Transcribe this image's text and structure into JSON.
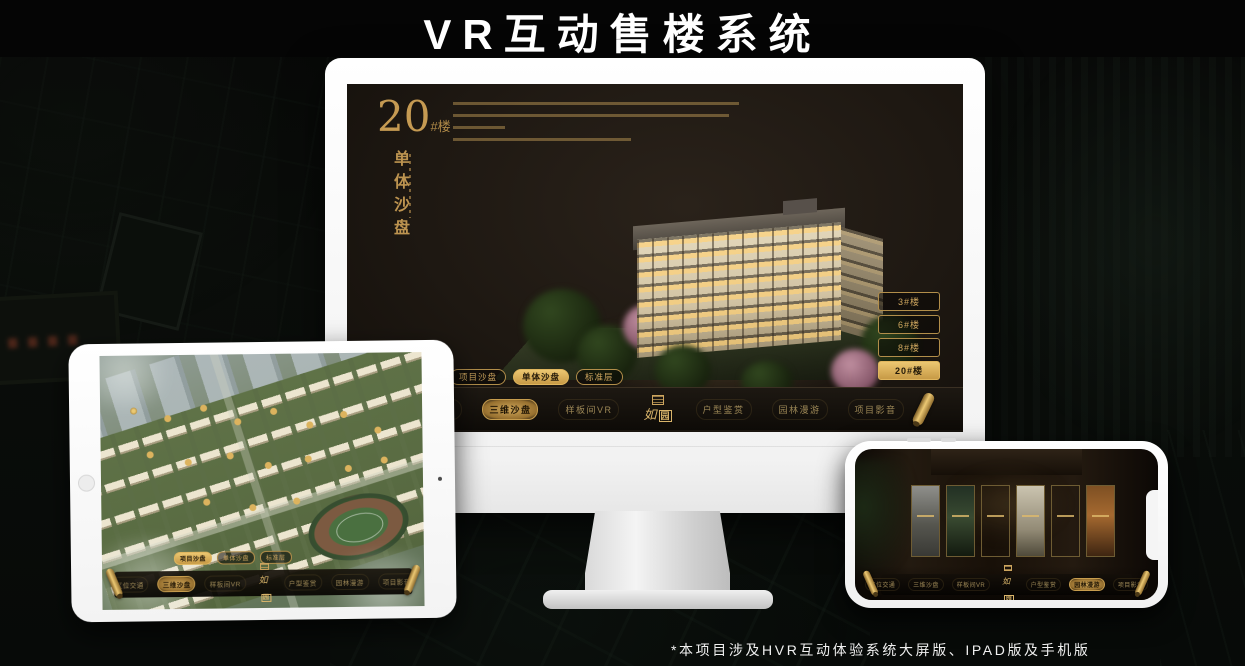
{
  "page": {
    "title": "VR互动售楼系统",
    "footnote": "*本项目涉及HVR互动体验系统大屏版、IPAD版及手机版"
  },
  "colors": {
    "gold_accent": "#cda55e",
    "gold_active": "#dcae54",
    "screen_bg": "#1e1812",
    "device_white": "#f5f5f5"
  },
  "screen": {
    "building_number": "20",
    "building_unit": "#楼",
    "subtitle": "单体沙盘",
    "floor_buttons": [
      "3#楼",
      "6#楼",
      "8#楼",
      "20#楼"
    ],
    "active_floor": "20#楼",
    "mode_tabs": [
      "项目沙盘",
      "单体沙盘",
      "标准层"
    ],
    "active_mode": "单体沙盘",
    "nav_items_left": [
      "区位交通",
      "三维沙盘",
      "样板间VR"
    ],
    "nav_items_right": [
      "户型鉴赏",
      "园林漫游",
      "项目影音"
    ],
    "active_nav": "三维沙盘",
    "logo_char1": "如",
    "logo_char2": "园"
  },
  "ipad": {
    "mode_tabs": [
      "项目沙盘",
      "单体沙盘",
      "标准层"
    ],
    "active_mode": "项目沙盘",
    "nav_items_left": [
      "区位交通",
      "三维沙盘",
      "样板间VR"
    ],
    "nav_items_right": [
      "户型鉴赏",
      "园林漫游",
      "项目影音"
    ],
    "active_nav": "三维沙盘",
    "logo_char1": "如",
    "logo_char2": "园"
  },
  "phone": {
    "nav_items_left": [
      "区位交通",
      "三维沙盘",
      "样板间VR"
    ],
    "nav_items_right": [
      "户型鉴赏",
      "园林漫游",
      "项目影音"
    ],
    "active_nav": "园林漫游",
    "logo_char1": "如",
    "logo_char2": "园"
  }
}
